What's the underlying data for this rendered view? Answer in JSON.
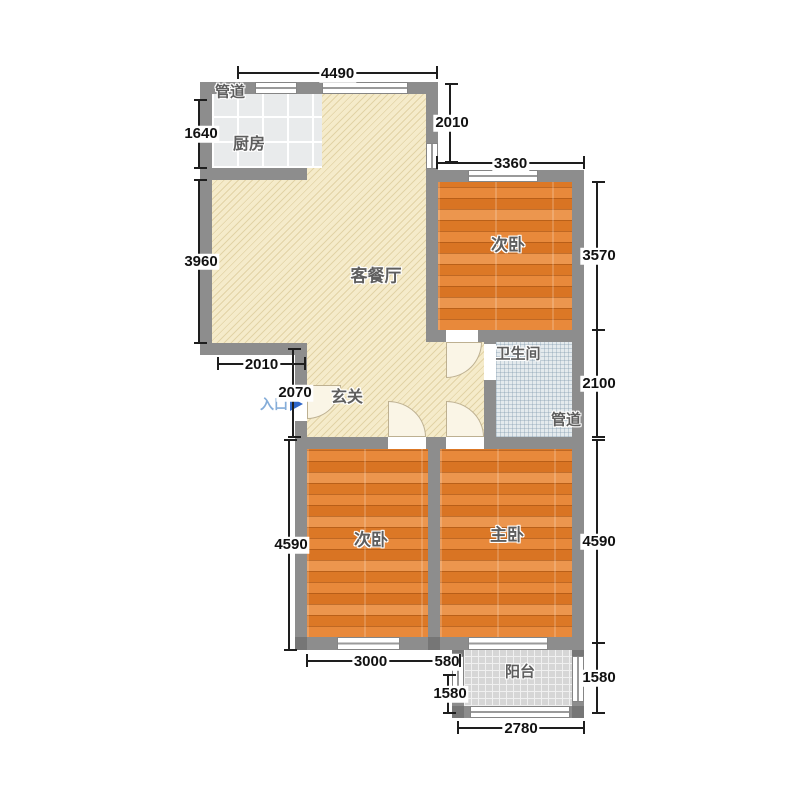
{
  "rooms": {
    "duct_top": {
      "label": "管道"
    },
    "kitchen": {
      "label": "厨房"
    },
    "living_dining": {
      "label": "客餐厅"
    },
    "bedroom_top": {
      "label": "次卧"
    },
    "bathroom": {
      "label": "卫生间"
    },
    "duct_right": {
      "label": "管道"
    },
    "hallway": {
      "label": "玄关"
    },
    "bedroom_left": {
      "label": "次卧"
    },
    "master_bedroom": {
      "label": "主卧"
    },
    "balcony": {
      "label": "阳台"
    }
  },
  "entrance": {
    "label": "入口"
  },
  "dims": {
    "top_width": "4490",
    "living_right_height": "2010",
    "bedroom_top_width": "3360",
    "kitchen_height": "1640",
    "living_left_height": "3960",
    "entry_width": "2010",
    "entry_height": "2070",
    "bedroom_top_height": "3570",
    "bathroom_height": "2100",
    "master_bedroom_height": "4590",
    "bedroom_left_height": "4590",
    "bedroom_left_width": "3000",
    "gap_width": "580",
    "balcony_left_height": "1580",
    "balcony_right_height": "1580",
    "balcony_width": "2780"
  },
  "colors": {
    "wall": "#8d8d8d",
    "living_floor": "#f5ebca",
    "wood_floor": "#e1812f",
    "bath_floor": "#e4eaed",
    "balcony_floor": "#d6d6d6",
    "kitchen_floor": "#e9ebec",
    "entry_blue": "#2e66c8"
  }
}
